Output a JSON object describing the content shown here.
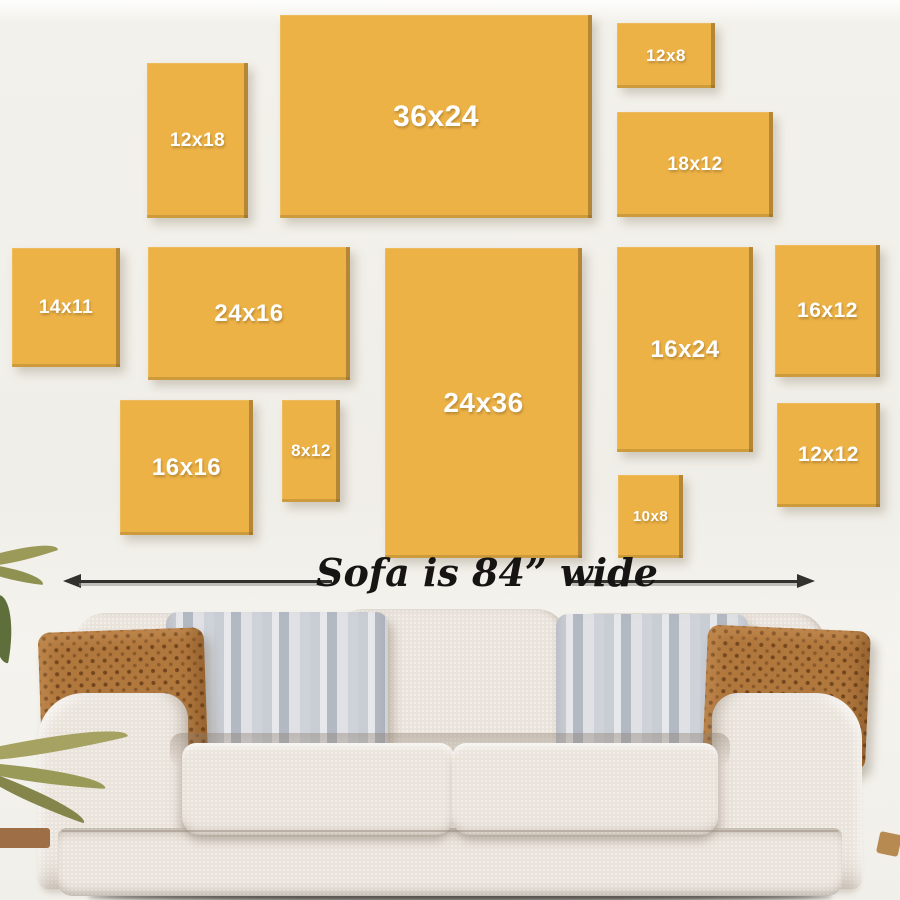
{
  "frames": [
    {
      "label": "12x18"
    },
    {
      "label": "36x24"
    },
    {
      "label": "12x8"
    },
    {
      "label": "18x12"
    },
    {
      "label": "14x11"
    },
    {
      "label": "24x16"
    },
    {
      "label": "24x36"
    },
    {
      "label": "16x24"
    },
    {
      "label": "16x12"
    },
    {
      "label": "16x16"
    },
    {
      "label": "8x12"
    },
    {
      "label": "10x8"
    },
    {
      "label": "12x12"
    }
  ],
  "sofa": {
    "caption": "Sofa is 84” wide",
    "width_inches": "84”"
  },
  "colors": {
    "frame_yellow": "#ecb246",
    "frame_edge": "#9d7a33",
    "label_white": "#ffffff",
    "wall": "#f1efe9",
    "arrow_black": "#33312e",
    "sofa_cream": "#eae3db",
    "pillow_brown": "#b1783e",
    "pillow_gray": "#c9cdd4",
    "plant_green": "#9c9a58"
  }
}
